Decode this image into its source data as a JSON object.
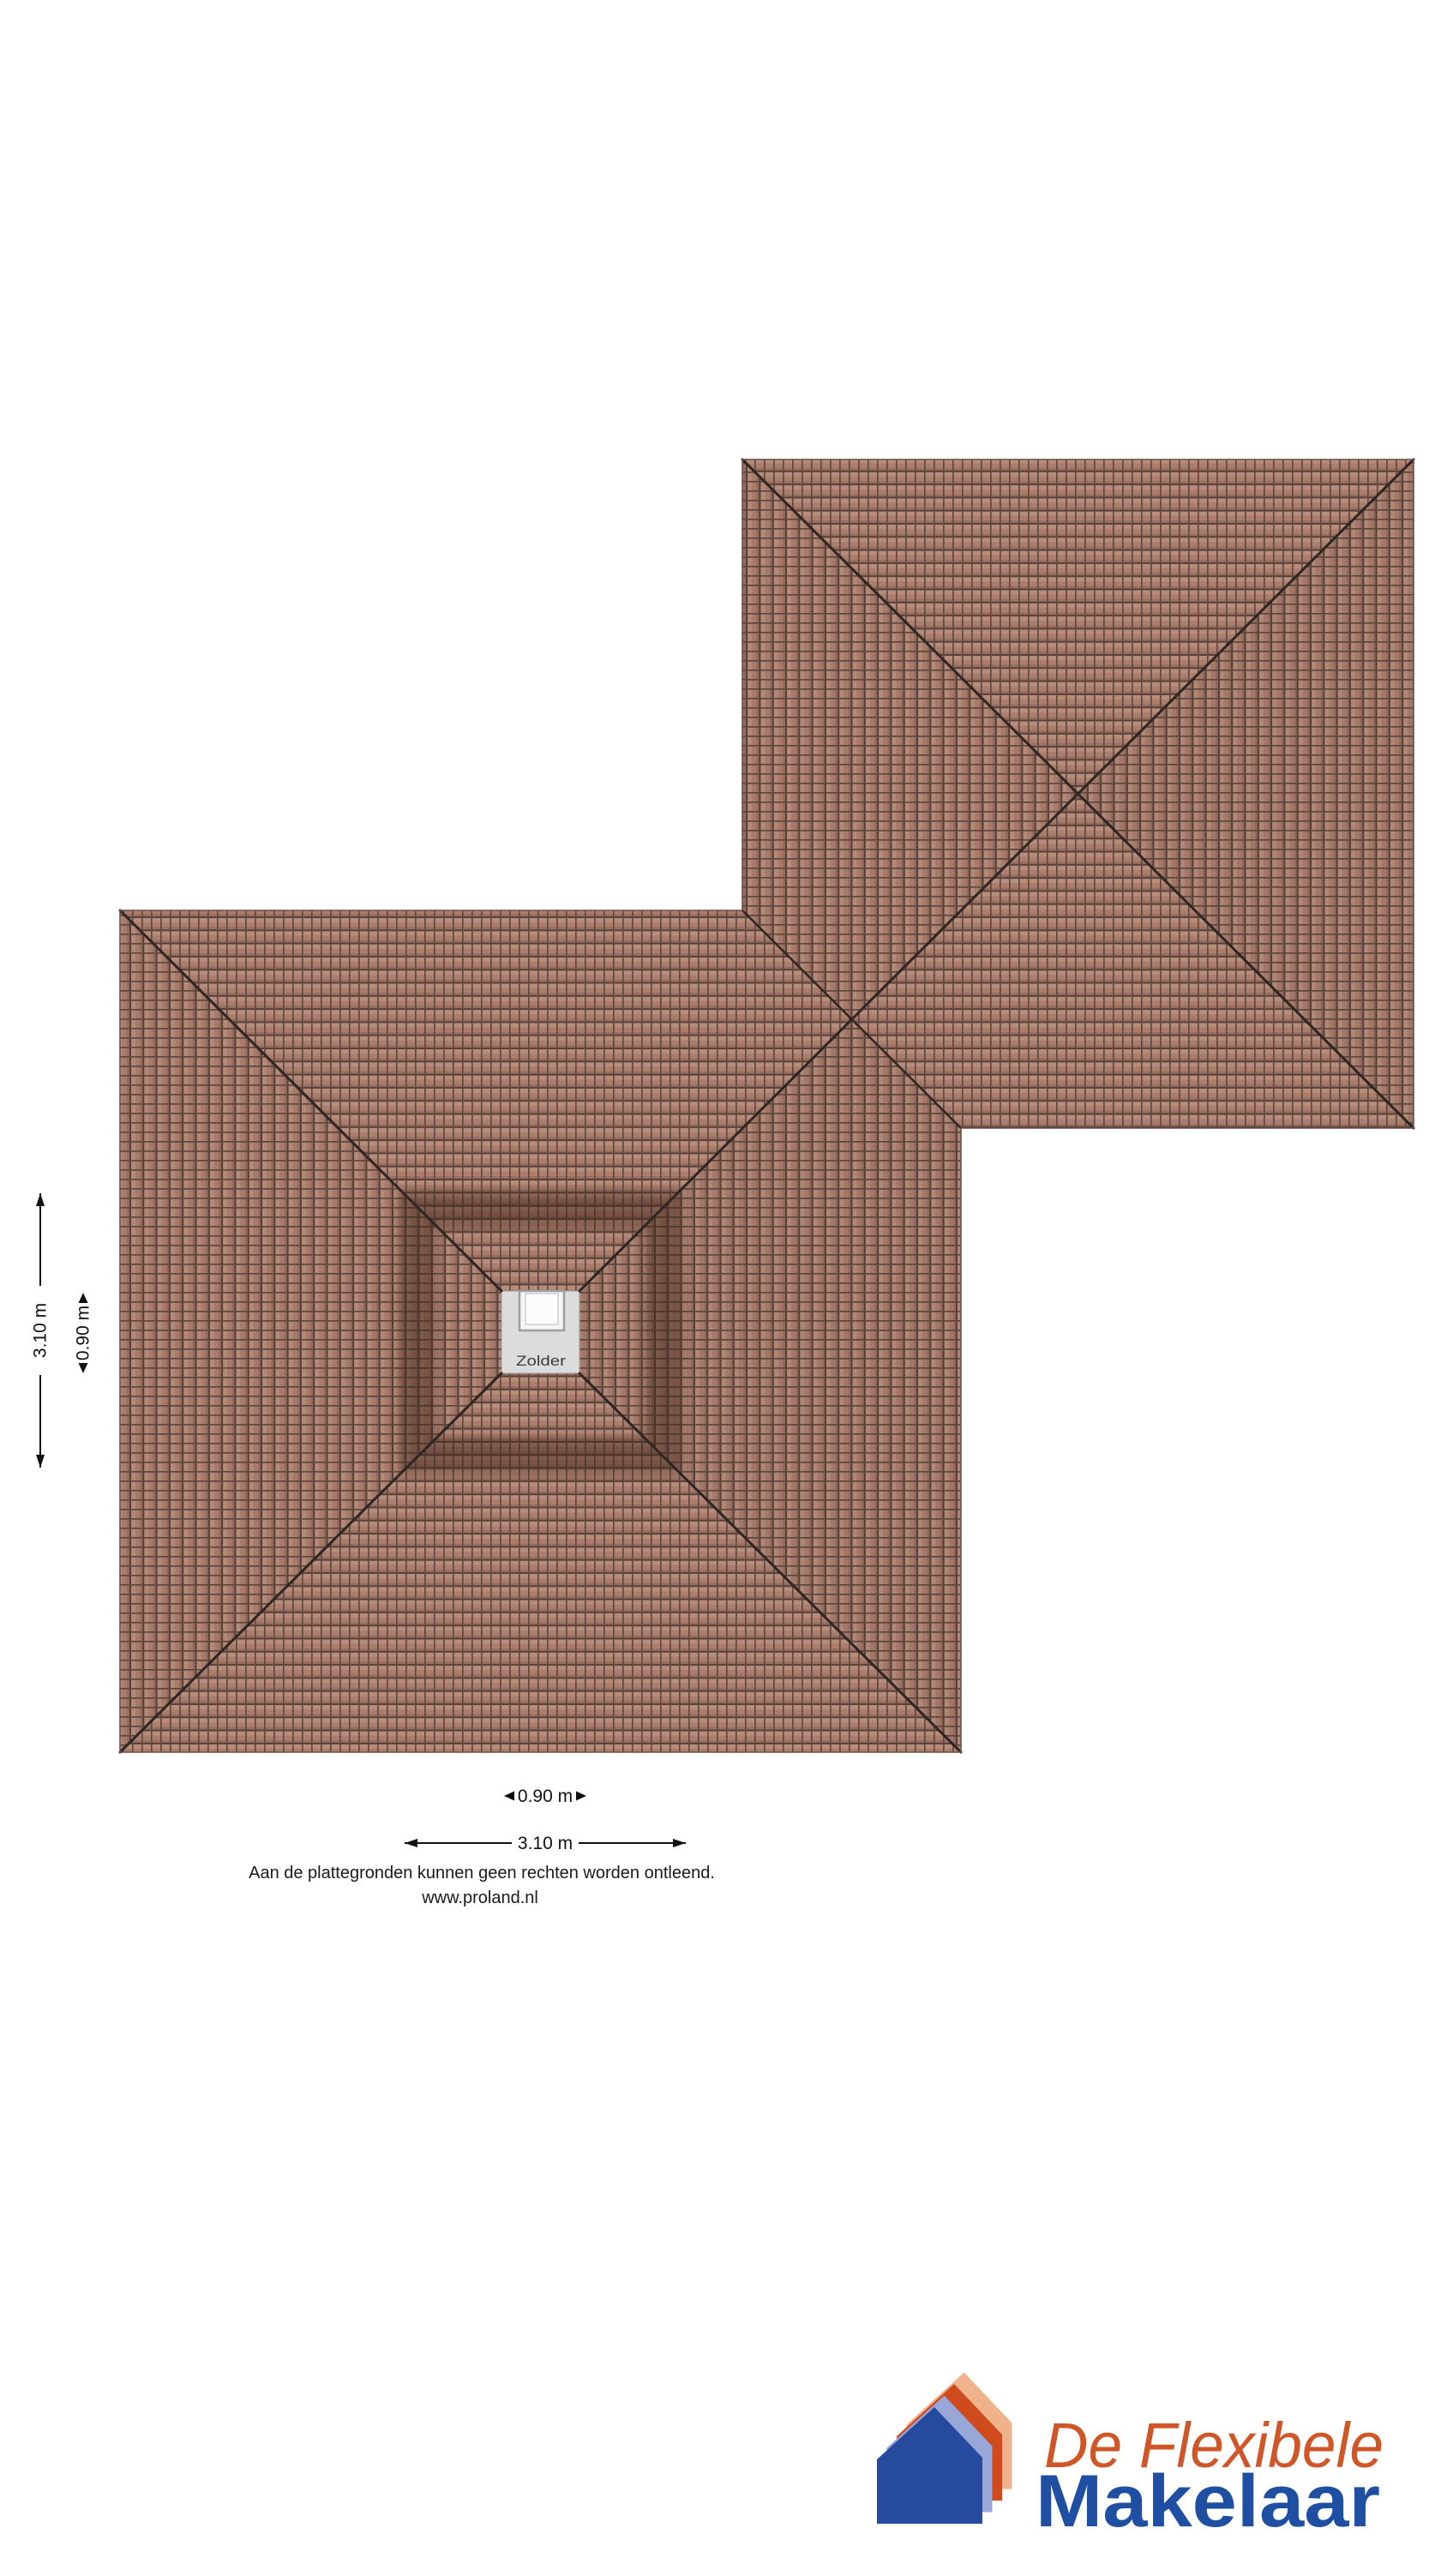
{
  "floorplan": {
    "room_label": "Zolder",
    "dim_left_outer": "3.10 m",
    "dim_left_inner": "0.90 m",
    "dim_bottom_inner": "0.90 m",
    "dim_bottom_outer": "3.10 m",
    "disclaimer": "Aan de plattegronden kunnen geen rechten worden ontleend.",
    "website": "www.proland.nl",
    "colors": {
      "tile_base": "#ab7d6d",
      "tile_highlight": "#b78c7a",
      "tile_shade": "#996e60",
      "tile_line_dark": "#55413a",
      "tile_line_soft": "#61493f",
      "roof_edge": "#6b5047",
      "ridge_line": "#2e2622",
      "recess_shadow": "#3a2315",
      "attic_opening": "#dcdcdc",
      "skylight_frame": "#9e9e9e",
      "dimension_ink": "#111111"
    }
  },
  "logo": {
    "title_top": "De Flexibele",
    "title_bottom": "Makelaar",
    "colors": {
      "orange_text": "#d05628",
      "blue_text": "#1f4fa3",
      "house_front_blue": "#254a9e",
      "house_periwinkle": "#98a6d8",
      "house_orange": "#cf4a1d",
      "house_peach": "#f0b28b"
    }
  }
}
